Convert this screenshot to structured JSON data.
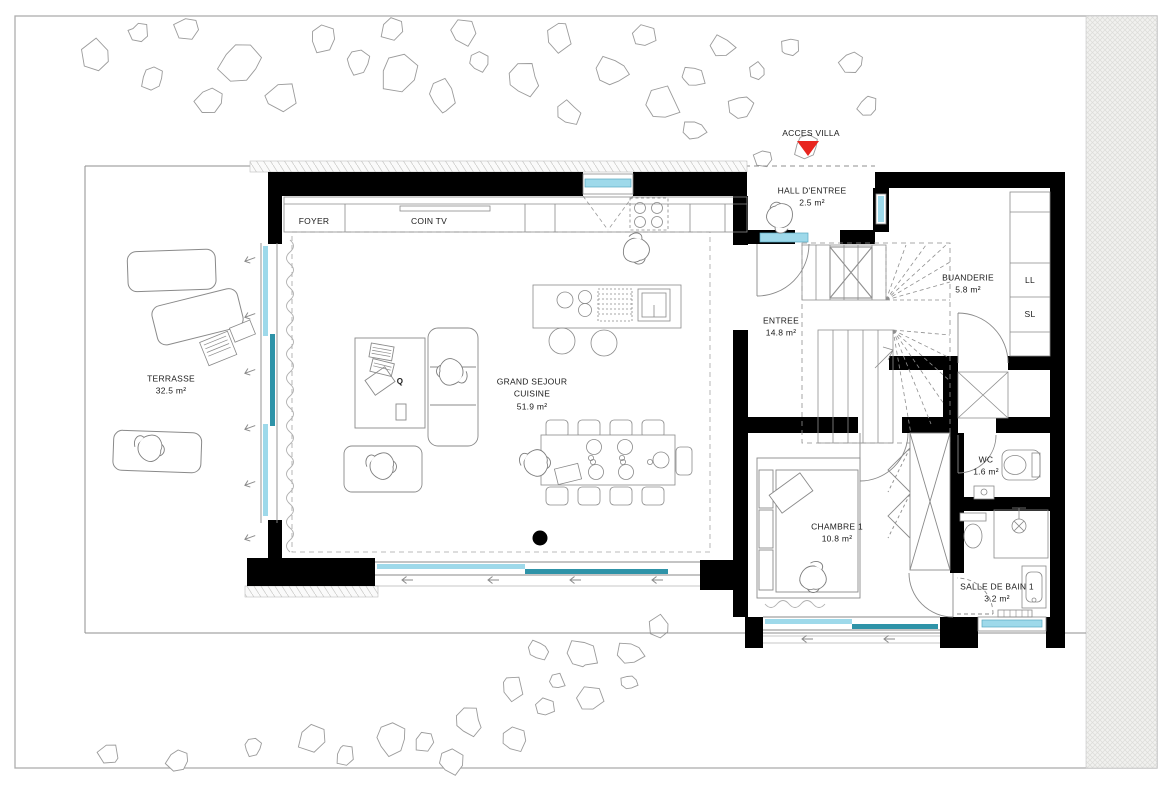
{
  "plan": {
    "access_label": "ACCES VILLA",
    "rooms": {
      "hall": {
        "name": "HALL D'ENTREE",
        "area": "2.5 m²"
      },
      "entree": {
        "name": "ENTREE",
        "area": "14.8 m²"
      },
      "buanderie": {
        "name": "BUANDERIE",
        "area": "5.8 m²"
      },
      "sejour": {
        "name": "GRAND SEJOUR",
        "name2": "CUISINE",
        "area": "51.9 m²"
      },
      "terrasse": {
        "name": "TERRASSE",
        "area": "32.5 m²"
      },
      "wc": {
        "name": "WC",
        "area": "1.6 m²"
      },
      "chambre": {
        "name": "CHAMBRE 1",
        "area": "10.8 m²"
      },
      "sdb": {
        "name": "SALLE DE BAIN 1",
        "area": "3.2 m²"
      }
    },
    "zones": {
      "foyer": "FOYER",
      "coin_tv": "COIN TV"
    },
    "appliances": {
      "washer": "LL",
      "dryer": "SL"
    },
    "decor": {
      "magazine": "Q"
    },
    "colors": {
      "accent_red": "#e8251f",
      "glazing_light": "#9ed9ea",
      "glazing_dark": "#2e93a8",
      "wall": "#000000"
    }
  }
}
